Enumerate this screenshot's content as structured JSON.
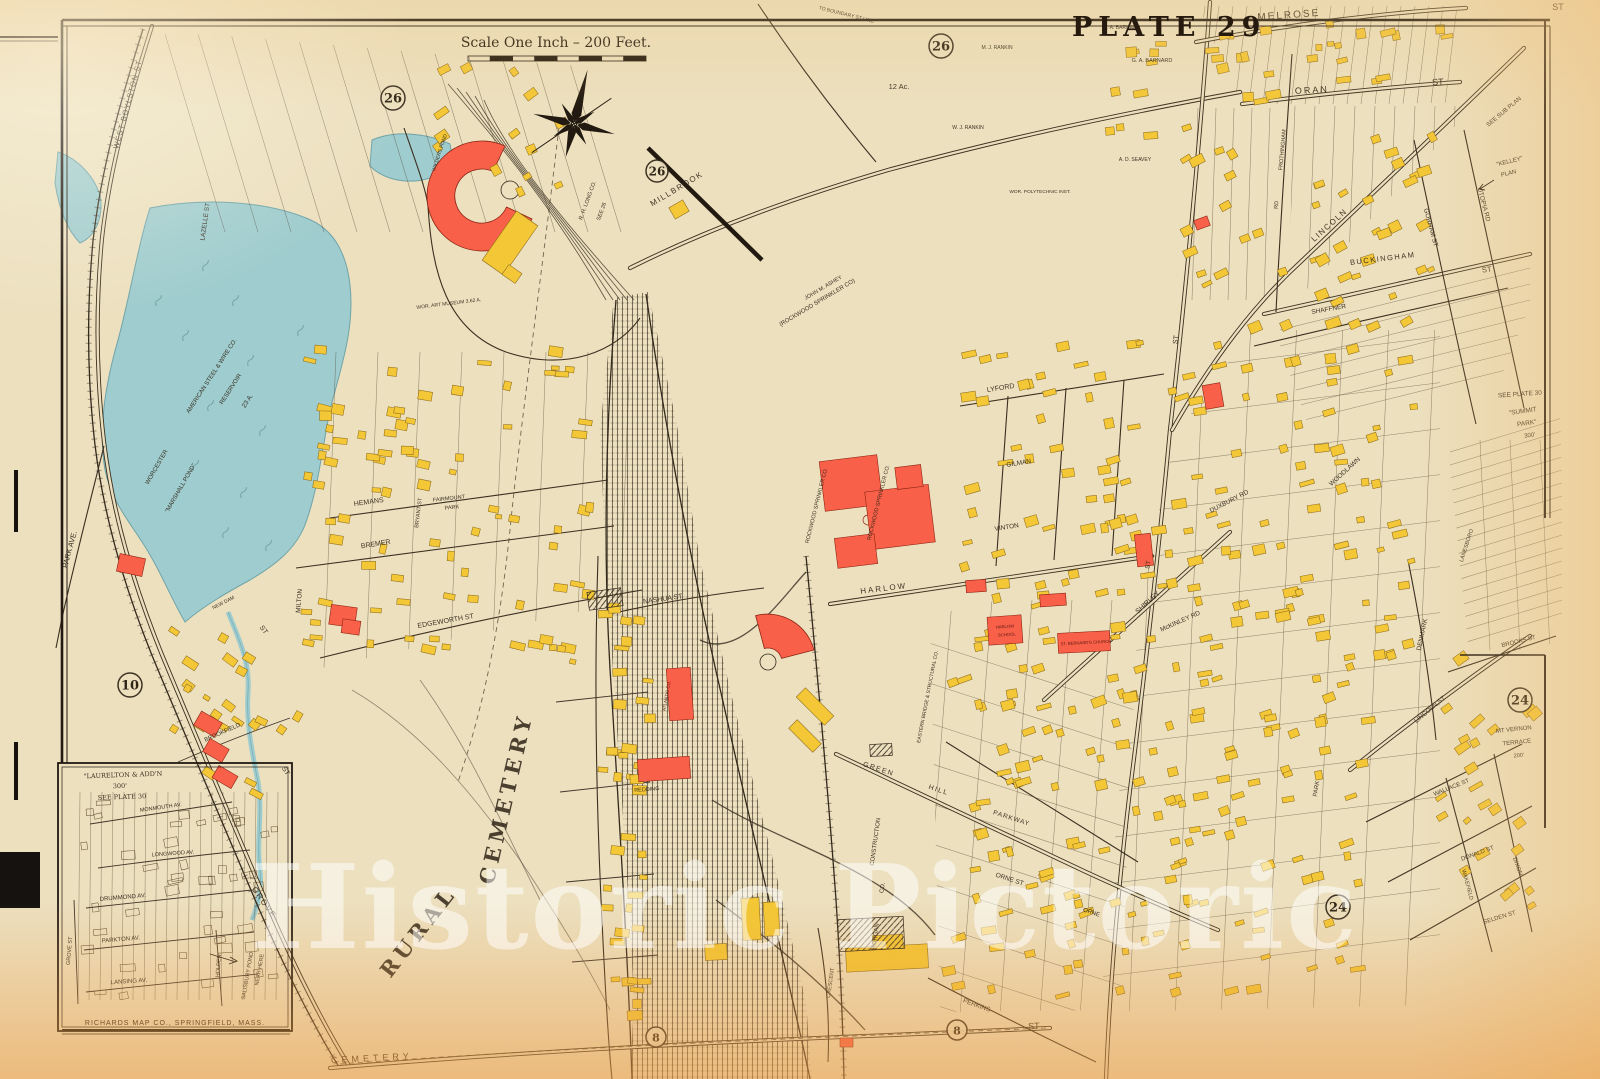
{
  "plate": {
    "title": "PLATE 29"
  },
  "scale": {
    "text": "Scale One Inch – 200 Feet."
  },
  "publisher": {
    "text": "RICHARDS MAP CO., SPRINGFIELD, MASS."
  },
  "watermark": {
    "text": "Historic Pictoric"
  },
  "colors": {
    "paper": "#ece0bf",
    "ink": "#2f2517",
    "water": "#9fccce",
    "water_edge": "#6fa3a8",
    "building_yellow": "#f3c736",
    "building_yellow_edge": "#8f6d1d",
    "building_red": "#f96049",
    "building_red_edge": "#8e2412"
  },
  "circled_numbers": [
    {
      "v": "26",
      "x": 393,
      "y": 98,
      "r": 12
    },
    {
      "v": "26",
      "x": 941,
      "y": 46,
      "r": 12
    },
    {
      "v": "26",
      "x": 657,
      "y": 171,
      "r": 11
    },
    {
      "v": "10",
      "x": 130,
      "y": 685,
      "r": 12
    },
    {
      "v": "24",
      "x": 1520,
      "y": 700,
      "r": 12
    },
    {
      "v": "24",
      "x": 1338,
      "y": 907,
      "r": 12
    },
    {
      "v": "8",
      "x": 656,
      "y": 1037,
      "r": 10
    },
    {
      "v": "8",
      "x": 957,
      "y": 1030,
      "r": 10
    }
  ],
  "map_labels": [
    {
      "t": "MELROSE",
      "x": 1289,
      "y": 18,
      "r": -4,
      "s": 10,
      "sp": 2
    },
    {
      "t": "ST",
      "x": 1558,
      "y": 10,
      "r": 0,
      "s": 9
    },
    {
      "t": "ORAN",
      "x": 1312,
      "y": 93,
      "r": -3,
      "s": 9,
      "sp": 2
    },
    {
      "t": "ST",
      "x": 1438,
      "y": 85,
      "r": -3,
      "s": 9
    },
    {
      "t": "G. A. BARNARD",
      "x": 1152,
      "y": 62,
      "r": 0,
      "s": 5.5
    },
    {
      "t": "S. A. BARNARD",
      "x": 1122,
      "y": 29,
      "r": 0,
      "s": 5
    },
    {
      "t": "M. J. RANKIN",
      "x": 997,
      "y": 49,
      "r": 0,
      "s": 5
    },
    {
      "t": "W. J. RANKIN",
      "x": 968,
      "y": 129,
      "r": 0,
      "s": 5
    },
    {
      "t": "A. D. SEAVEY",
      "x": 1135,
      "y": 161,
      "r": 0,
      "s": 5
    },
    {
      "t": "WOR. POLYTECHNIC INST.",
      "x": 1040,
      "y": 193,
      "r": 0,
      "s": 4.8
    },
    {
      "t": "12 Ac.",
      "x": 899,
      "y": 89,
      "r": 0,
      "s": 7.5
    },
    {
      "t": "TO BOUNDARY ST LINE",
      "x": 846,
      "y": 16,
      "r": 14,
      "s": 5
    },
    {
      "t": "MILLBROOK",
      "x": 678,
      "y": 191,
      "r": -31,
      "s": 8,
      "sp": 1.5
    },
    {
      "t": "R. H. LONG CO.",
      "x": 589,
      "y": 201,
      "r": -70,
      "s": 5.5
    },
    {
      "t": "SEE 26",
      "x": 603,
      "y": 212,
      "r": -70,
      "s": 5.5
    },
    {
      "t": "WILDERS POND",
      "x": 441,
      "y": 153,
      "r": -72,
      "s": 5
    },
    {
      "t": "WEST BOYLSTON ST",
      "x": 130,
      "y": 105,
      "r": -75,
      "s": 7.5,
      "sp": 1
    },
    {
      "t": "LAZELLE ST",
      "x": 207,
      "y": 222,
      "r": -82,
      "s": 6.5
    },
    {
      "t": "WOR. ART MUSEUM 3.62 A.",
      "x": 449,
      "y": 305,
      "r": -7,
      "s": 5
    },
    {
      "t": "AMERICAN STEEL & WIRE CO.",
      "x": 213,
      "y": 377,
      "r": -57,
      "s": 6
    },
    {
      "t": "RESERVOIR",
      "x": 232,
      "y": 390,
      "r": -57,
      "s": 6
    },
    {
      "t": "23 A.",
      "x": 249,
      "y": 402,
      "r": -57,
      "s": 6.5
    },
    {
      "t": "WORCESTER",
      "x": 158,
      "y": 468,
      "r": -60,
      "s": 6
    },
    {
      "t": "\"MARSHALL POND\"",
      "x": 182,
      "y": 489,
      "r": -60,
      "s": 6
    },
    {
      "t": "NEW DAM",
      "x": 224,
      "y": 604,
      "r": -27,
      "s": 5
    },
    {
      "t": "PARK AVE.",
      "x": 72,
      "y": 550,
      "r": -75,
      "s": 7.5
    },
    {
      "t": "MILTON",
      "x": 301,
      "y": 601,
      "r": -85,
      "s": 6.5
    },
    {
      "t": "HEMANS",
      "x": 369,
      "y": 504,
      "r": -8,
      "s": 7
    },
    {
      "t": "FAIRMOUNT",
      "x": 449,
      "y": 500,
      "r": -6,
      "s": 5.5
    },
    {
      "t": "PARK",
      "x": 452,
      "y": 509,
      "r": -6,
      "s": 5.5
    },
    {
      "t": "BREMER",
      "x": 376,
      "y": 546,
      "r": -9,
      "s": 7
    },
    {
      "t": "BRYANT ST",
      "x": 420,
      "y": 513,
      "r": -83,
      "s": 5.5
    },
    {
      "t": "EDGEWORTH ST",
      "x": 446,
      "y": 623,
      "r": -10,
      "s": 7
    },
    {
      "t": "ST",
      "x": 262,
      "y": 631,
      "r": 55,
      "s": 7
    },
    {
      "t": "GROVE",
      "x": 262,
      "y": 904,
      "r": 55,
      "s": 8,
      "sp": 1.5
    },
    {
      "t": "ST",
      "x": 284,
      "y": 772,
      "r": 58,
      "s": 7
    },
    {
      "t": "BROOKFIELD",
      "x": 223,
      "y": 734,
      "r": -24,
      "s": 6
    },
    {
      "t": "SALISBURY POND",
      "x": 249,
      "y": 976,
      "r": -80,
      "s": 5.5
    },
    {
      "t": "NEAR HERE",
      "x": 261,
      "y": 970,
      "r": -80,
      "s": 5.5
    },
    {
      "t": "\"LAURELTON & ADD'N",
      "x": 123,
      "y": 777,
      "r": -2,
      "s": 6.5,
      "f": 1
    },
    {
      "t": "300'",
      "x": 120,
      "y": 788,
      "r": -2,
      "s": 6.5,
      "f": 1
    },
    {
      "t": "SEE PLATE 30",
      "x": 122,
      "y": 799,
      "r": -2,
      "s": 6.5,
      "f": 1
    },
    {
      "t": "MONMOUTH AV.",
      "x": 161,
      "y": 809,
      "r": -8,
      "s": 5.5
    },
    {
      "t": "LONGWOOD AV.",
      "x": 173,
      "y": 855,
      "r": -4,
      "s": 5.5
    },
    {
      "t": "DRUMMOND AV.",
      "x": 123,
      "y": 899,
      "r": -5,
      "s": 6
    },
    {
      "t": "PARKTON AV.",
      "x": 121,
      "y": 941,
      "r": -5,
      "s": 6
    },
    {
      "t": "LANSING AV.",
      "x": 129,
      "y": 983,
      "r": -4,
      "s": 6
    },
    {
      "t": "GROVE ST",
      "x": 71,
      "y": 951,
      "r": -85,
      "s": 5.5
    },
    {
      "t": "HOLDEN",
      "x": 220,
      "y": 966,
      "r": -85,
      "s": 5.5
    },
    {
      "t": "RURAL",
      "x": 424,
      "y": 936,
      "r": -52,
      "s": 21,
      "f": 1,
      "b": 1,
      "sp": 5,
      "o": 0.85
    },
    {
      "t": "CEMETERY",
      "x": 513,
      "y": 800,
      "r": -77,
      "s": 21,
      "f": 1,
      "b": 1,
      "sp": 5,
      "o": 0.85
    },
    {
      "t": "CEMETERY",
      "x": 372,
      "y": 1061,
      "r": -3,
      "s": 9,
      "sp": 4
    },
    {
      "t": "ST",
      "x": 1034,
      "y": 1029,
      "r": -2,
      "s": 9
    },
    {
      "t": "JOHN M. ASHEY",
      "x": 824,
      "y": 289,
      "r": -31,
      "s": 5.5
    },
    {
      "t": "(ROCKWOOD SPRINKLER CO)",
      "x": 818,
      "y": 304,
      "r": -31,
      "s": 6
    },
    {
      "t": "ROCKWOOD SPRINKLER CO.",
      "x": 818,
      "y": 506,
      "r": -76,
      "s": 5.5
    },
    {
      "t": "ROCKWOOD SPRINKLER CO.",
      "x": 880,
      "y": 503,
      "r": -76,
      "s": 5.5
    },
    {
      "t": "HARLOW",
      "x": 884,
      "y": 591,
      "r": -7,
      "s": 8,
      "sp": 2
    },
    {
      "t": "HARLOW",
      "x": 1005,
      "y": 628,
      "r": -4,
      "s": 4.2,
      "c": "#4a130b"
    },
    {
      "t": "SCHOOL",
      "x": 1007,
      "y": 636,
      "r": -4,
      "s": 4.2,
      "c": "#4a130b"
    },
    {
      "t": "ST. BERNARD'S CHURCH",
      "x": 1086,
      "y": 644,
      "r": -3,
      "s": 4.2,
      "c": "#4a130b"
    },
    {
      "t": "ATLANTIC CO.",
      "x": 668,
      "y": 696,
      "r": -80,
      "s": 4.5,
      "c": "#4a130b"
    },
    {
      "t": "LYFORD",
      "x": 1001,
      "y": 390,
      "r": -9,
      "s": 7
    },
    {
      "t": "GILMAN",
      "x": 1019,
      "y": 465,
      "r": -9,
      "s": 6.5
    },
    {
      "t": "VINTON",
      "x": 1007,
      "y": 529,
      "r": -9,
      "s": 6.5
    },
    {
      "t": "DUXBURY RD",
      "x": 1230,
      "y": 503,
      "r": -27,
      "s": 6.5
    },
    {
      "t": "McKINLEY RD",
      "x": 1181,
      "y": 623,
      "r": -24,
      "s": 6.5
    },
    {
      "t": "WOODLAWN",
      "x": 1346,
      "y": 473,
      "r": -42,
      "s": 6.5
    },
    {
      "t": "SHIRLEY",
      "x": 1149,
      "y": 604,
      "r": -42,
      "s": 7
    },
    {
      "t": "LINCOLN",
      "x": 1331,
      "y": 227,
      "r": -42,
      "s": 8,
      "sp": 1.5
    },
    {
      "t": "FROTHINGHAM",
      "x": 1284,
      "y": 150,
      "r": -85,
      "s": 5.5
    },
    {
      "t": "RD",
      "x": 1278,
      "y": 205,
      "r": -85,
      "s": 5.5
    },
    {
      "t": "BUCKINGHAM",
      "x": 1383,
      "y": 261,
      "r": -7,
      "s": 7.5,
      "sp": 1.5
    },
    {
      "t": "ST",
      "x": 1487,
      "y": 272,
      "r": -7,
      "s": 7.5
    },
    {
      "t": "SHAFFNER",
      "x": 1329,
      "y": 311,
      "r": -10,
      "s": 6.5
    },
    {
      "t": "GORHAM ST",
      "x": 1429,
      "y": 228,
      "r": 75,
      "s": 6.5
    },
    {
      "t": "UTOPIA RD",
      "x": 1482,
      "y": 205,
      "r": 75,
      "s": 6.5
    },
    {
      "t": "SEE SUB PLAN",
      "x": 1505,
      "y": 113,
      "r": -40,
      "s": 6
    },
    {
      "t": "\"KELLEY\"",
      "x": 1510,
      "y": 163,
      "r": -14,
      "s": 6
    },
    {
      "t": "PLAN",
      "x": 1509,
      "y": 175,
      "r": -14,
      "s": 6
    },
    {
      "t": "SEE PLATE 30",
      "x": 1520,
      "y": 396,
      "r": -4,
      "s": 6.5
    },
    {
      "t": "\"SUMMIT",
      "x": 1523,
      "y": 413,
      "r": -8,
      "s": 6.5
    },
    {
      "t": "PARK\"",
      "x": 1527,
      "y": 425,
      "r": -8,
      "s": 6.5
    },
    {
      "t": "300'",
      "x": 1530,
      "y": 437,
      "r": -8,
      "s": 6
    },
    {
      "t": "DENMARK",
      "x": 1424,
      "y": 635,
      "r": -78,
      "s": 6.5
    },
    {
      "t": "LANESBORO",
      "x": 1468,
      "y": 546,
      "r": -72,
      "s": 5.5
    },
    {
      "t": "BROOKS ST",
      "x": 1519,
      "y": 643,
      "r": -14,
      "s": 6
    },
    {
      "t": "MT VERNON",
      "x": 1514,
      "y": 731,
      "r": -6,
      "s": 6
    },
    {
      "t": "TERRACE",
      "x": 1517,
      "y": 744,
      "r": -6,
      "s": 6
    },
    {
      "t": "200'",
      "x": 1519,
      "y": 757,
      "r": -6,
      "s": 5.5
    },
    {
      "t": "LINCOLN ST",
      "x": 1431,
      "y": 711,
      "r": -40,
      "s": 6.5
    },
    {
      "t": "WALLACE ST",
      "x": 1452,
      "y": 789,
      "r": -22,
      "s": 6
    },
    {
      "t": "DONALD ST",
      "x": 1478,
      "y": 855,
      "r": -20,
      "s": 6
    },
    {
      "t": "SELDEN ST",
      "x": 1500,
      "y": 919,
      "r": -17,
      "s": 6
    },
    {
      "t": "DIXON",
      "x": 1516,
      "y": 867,
      "r": 70,
      "s": 6
    },
    {
      "t": "WAKEFIELD",
      "x": 1466,
      "y": 885,
      "r": 75,
      "s": 5.5
    },
    {
      "t": "GREEN",
      "x": 878,
      "y": 771,
      "r": 18,
      "s": 7,
      "sp": 1.5
    },
    {
      "t": "HILL",
      "x": 938,
      "y": 792,
      "r": 18,
      "s": 7,
      "sp": 1.5
    },
    {
      "t": "PARKWAY",
      "x": 1011,
      "y": 820,
      "r": 18,
      "s": 6.5,
      "sp": 1
    },
    {
      "t": "ORNE ST",
      "x": 1009,
      "y": 881,
      "r": 18,
      "s": 6.5
    },
    {
      "t": "ORNE",
      "x": 1091,
      "y": 914,
      "r": 18,
      "s": 6
    },
    {
      "t": "CONSTRUCTION",
      "x": 877,
      "y": 842,
      "r": -82,
      "s": 6
    },
    {
      "t": "CO.",
      "x": 884,
      "y": 888,
      "r": -82,
      "s": 6
    },
    {
      "t": "MORGAN",
      "x": 877,
      "y": 937,
      "r": -82,
      "s": 6
    },
    {
      "t": "EASTERN BRIDGE & STRUCTURAL CO.",
      "x": 929,
      "y": 697,
      "r": -79,
      "s": 5
    },
    {
      "t": "CRESCENT",
      "x": 832,
      "y": 983,
      "r": -82,
      "s": 5.5
    },
    {
      "t": "PERKINS",
      "x": 976,
      "y": 1007,
      "r": 20,
      "s": 6.5
    },
    {
      "t": "NASHUA ST",
      "x": 663,
      "y": 601,
      "r": -8,
      "s": 7
    },
    {
      "t": "REDDING",
      "x": 647,
      "y": 791,
      "r": -4,
      "s": 5.5
    },
    {
      "t": "ST",
      "x": 1178,
      "y": 340,
      "r": -82,
      "s": 7
    },
    {
      "t": "ST",
      "x": 1150,
      "y": 565,
      "r": -82,
      "s": 6.5
    },
    {
      "t": "PARK",
      "x": 1318,
      "y": 789,
      "r": -80,
      "s": 6
    }
  ],
  "building_clusters": [
    {
      "x": 1180,
      "y": 120,
      "w": 260,
      "h": 215,
      "n": 48,
      "rot": -25
    },
    {
      "x": 960,
      "y": 340,
      "w": 460,
      "h": 320,
      "n": 150,
      "rot": -12
    },
    {
      "x": 940,
      "y": 660,
      "w": 440,
      "h": 340,
      "n": 150,
      "rot": -15
    },
    {
      "x": 1205,
      "y": 20,
      "w": 250,
      "h": 90,
      "n": 26,
      "rot": -8
    },
    {
      "x": 1070,
      "y": 25,
      "w": 110,
      "h": 120,
      "n": 10,
      "rot": -4
    },
    {
      "x": 300,
      "y": 345,
      "w": 310,
      "h": 320,
      "n": 85,
      "rot": 8
    },
    {
      "x": 430,
      "y": 55,
      "w": 140,
      "h": 170,
      "n": 14,
      "rot": -30
    },
    {
      "x": 168,
      "y": 628,
      "w": 140,
      "h": 190,
      "n": 26,
      "rot": 32
    },
    {
      "x": 598,
      "y": 600,
      "w": 66,
      "h": 430,
      "n": 40,
      "rot": 3
    },
    {
      "x": 1435,
      "y": 650,
      "w": 110,
      "h": 290,
      "n": 24,
      "rot": -35
    },
    {
      "x": 75,
      "y": 795,
      "w": 205,
      "h": 205,
      "n": 46,
      "rot": -6,
      "outline": true
    }
  ],
  "red_buildings": [
    {
      "x": 118,
      "y": 556,
      "w": 26,
      "h": 18,
      "r": 12
    },
    {
      "x": 196,
      "y": 716,
      "w": 24,
      "h": 16,
      "r": 30
    },
    {
      "x": 205,
      "y": 743,
      "w": 22,
      "h": 15,
      "r": 30
    },
    {
      "x": 214,
      "y": 770,
      "w": 22,
      "h": 14,
      "r": 30
    },
    {
      "x": 330,
      "y": 606,
      "w": 26,
      "h": 20,
      "r": 8
    },
    {
      "x": 342,
      "y": 620,
      "w": 18,
      "h": 14,
      "r": 8
    },
    {
      "x": 822,
      "y": 458,
      "w": 58,
      "h": 50,
      "r": -7
    },
    {
      "x": 868,
      "y": 488,
      "w": 64,
      "h": 58,
      "r": -7
    },
    {
      "x": 836,
      "y": 536,
      "w": 40,
      "h": 30,
      "r": -7
    },
    {
      "x": 896,
      "y": 466,
      "w": 26,
      "h": 22,
      "r": -7
    },
    {
      "x": 668,
      "y": 668,
      "w": 24,
      "h": 52,
      "r": -4
    },
    {
      "x": 638,
      "y": 758,
      "w": 52,
      "h": 22,
      "r": -4
    },
    {
      "x": 988,
      "y": 616,
      "w": 34,
      "h": 28,
      "r": -4
    },
    {
      "x": 1058,
      "y": 632,
      "w": 52,
      "h": 20,
      "r": -3
    },
    {
      "x": 966,
      "y": 580,
      "w": 20,
      "h": 12,
      "r": -4
    },
    {
      "x": 1040,
      "y": 594,
      "w": 26,
      "h": 12,
      "r": -4
    },
    {
      "x": 1136,
      "y": 534,
      "w": 16,
      "h": 32,
      "r": -6
    },
    {
      "x": 1204,
      "y": 384,
      "w": 18,
      "h": 24,
      "r": -10
    },
    {
      "x": 1195,
      "y": 218,
      "w": 14,
      "h": 10,
      "r": -20
    },
    {
      "x": 840,
      "y": 1038,
      "w": 13,
      "h": 9,
      "r": 0
    }
  ],
  "yellow_buildings": [
    {
      "x": 497,
      "y": 213,
      "w": 26,
      "h": 60,
      "r": 35
    },
    {
      "x": 504,
      "y": 268,
      "w": 16,
      "h": 12,
      "r": 35
    },
    {
      "x": 795,
      "y": 700,
      "w": 40,
      "h": 13,
      "r": 45
    },
    {
      "x": 788,
      "y": 730,
      "w": 34,
      "h": 12,
      "r": 45
    },
    {
      "x": 742,
      "y": 898,
      "w": 18,
      "h": 42,
      "r": -3
    },
    {
      "x": 764,
      "y": 902,
      "w": 15,
      "h": 34,
      "r": -3
    },
    {
      "x": 705,
      "y": 944,
      "w": 22,
      "h": 16,
      "r": -3
    },
    {
      "x": 846,
      "y": 946,
      "w": 82,
      "h": 24,
      "r": -3
    },
    {
      "x": 873,
      "y": 935,
      "w": 30,
      "h": 14,
      "r": -3
    },
    {
      "x": 671,
      "y": 203,
      "w": 16,
      "h": 13,
      "r": -30
    }
  ],
  "hatched_buildings": [
    {
      "x": 838,
      "y": 918,
      "w": 66,
      "h": 32,
      "r": -3
    },
    {
      "x": 870,
      "y": 744,
      "w": 22,
      "h": 12,
      "r": -3
    },
    {
      "x": 588,
      "y": 590,
      "w": 34,
      "h": 18,
      "r": -8
    }
  ]
}
